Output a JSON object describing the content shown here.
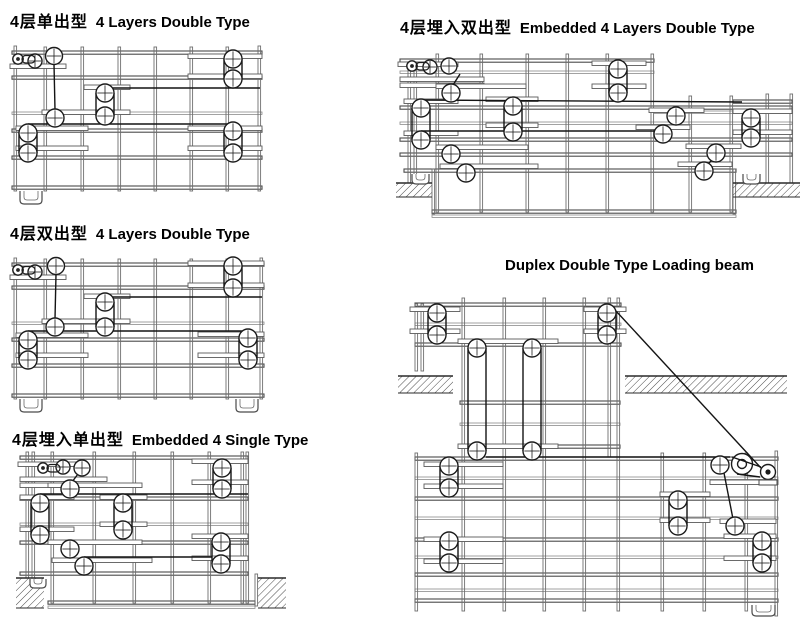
{
  "page": {
    "background": "#ffffff",
    "text_color": "#000000",
    "line_color": "#4a4a4a"
  },
  "captions": {
    "c1": {
      "zh": "4层单出型",
      "en": "4 Layers Double Type"
    },
    "c2": {
      "zh": "4层埋入双出型",
      "en": "Embedded 4 Layers Double Type"
    },
    "c3": {
      "zh": "4层双出型",
      "en": "4 Layers Double Type"
    },
    "c4": {
      "en": "Duplex Double Type Loading beam"
    },
    "c5": {
      "zh": "4层埋入单出型",
      "en": "Embedded 4 Single Type"
    }
  },
  "diagrams": [
    {
      "id": "d1",
      "name": "4-layers-single-out-type",
      "caption": "4层单出型 4 Layers Double Type"
    },
    {
      "id": "d2",
      "name": "embedded-4-layers-double-type",
      "caption": "4层埋入双出型 Embedded 4 Layers Double Type"
    },
    {
      "id": "d3",
      "name": "4-layers-double-out-type",
      "caption": "4层双出型 4 Layers Double Type"
    },
    {
      "id": "d4",
      "name": "embedded-4-single-type",
      "caption": "4层埋入单出型 Embedded 4 Single Type"
    },
    {
      "id": "d5",
      "name": "duplex-double-type-loading-beam",
      "caption": "Duplex Double Type Loading beam"
    }
  ]
}
